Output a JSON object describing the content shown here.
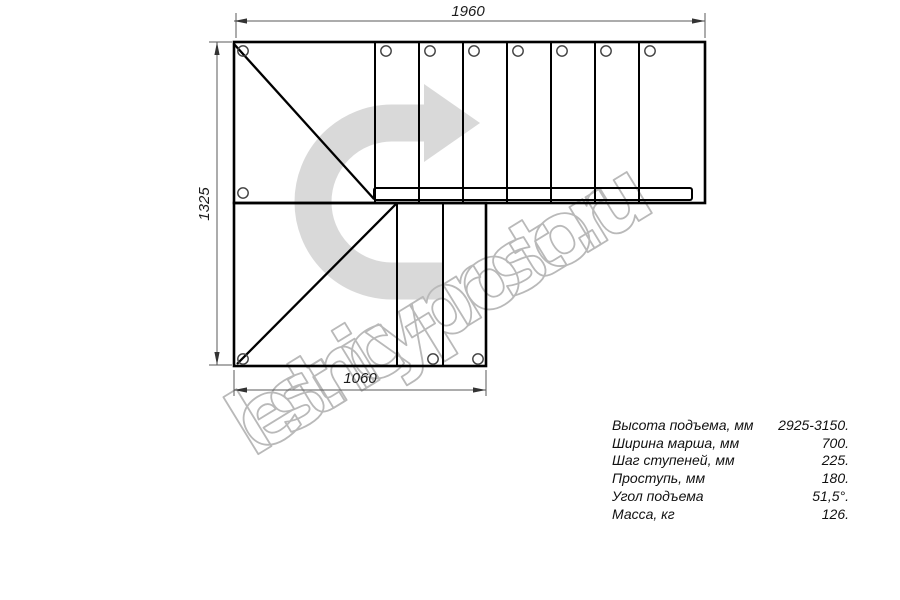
{
  "drawing": {
    "title": "staircase-plan-top-view",
    "dimensions": {
      "top_width_mm": "1960",
      "left_height_mm": "1325",
      "bottom_width_mm": "1060"
    },
    "watermark_text": "lestnicy-prosto.ru",
    "colors": {
      "drawing_line": "#000000",
      "dimension_line": "#5a5a5a",
      "direction_arrow_fill": "#d9d9d9",
      "watermark_outline": "#b9b9b9"
    }
  },
  "specs": {
    "rows": [
      {
        "label": "Высота подъема, мм",
        "value": "2925-3150."
      },
      {
        "label": "Ширина марша, мм",
        "value": "700."
      },
      {
        "label": "Шаг ступеней, мм",
        "value": "225."
      },
      {
        "label": "Проступь, мм",
        "value": "180."
      },
      {
        "label": "Угол подъема",
        "value": "51,5°."
      },
      {
        "label": "Масса, кг",
        "value": "126."
      }
    ]
  }
}
